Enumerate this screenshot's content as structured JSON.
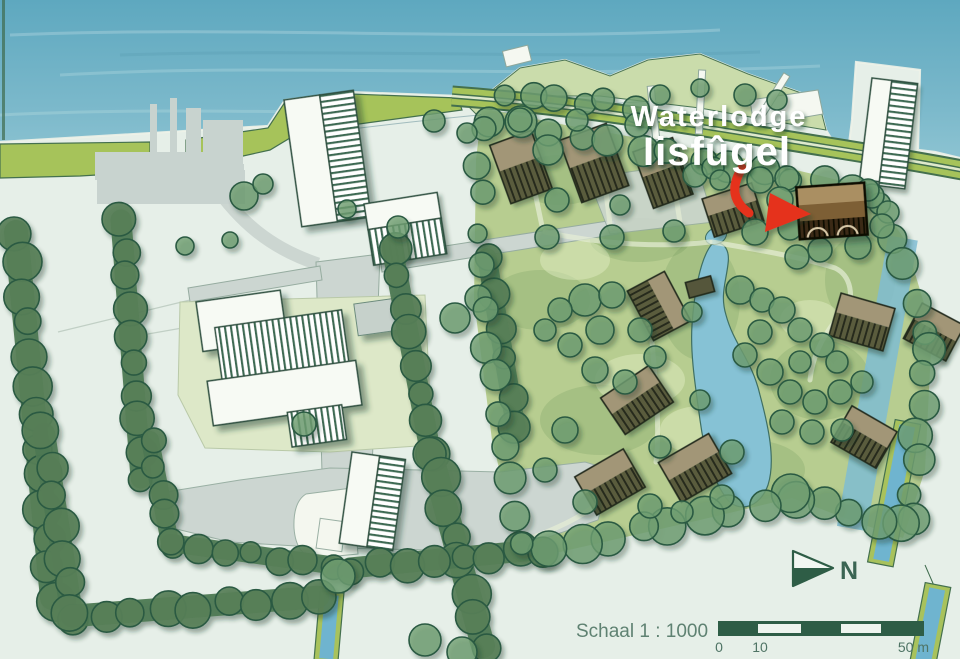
{
  "title": {
    "line1": "Waterlodge",
    "line2": "Iisfûgel"
  },
  "annotations": {
    "north_label": "N",
    "scale_label": "Schaal 1 : 1000",
    "scale_tick_0": "0",
    "scale_tick_10": "10",
    "scale_tick_50": "50 m"
  },
  "colors": {
    "water": "#69aec4",
    "water_shallow": "#93c7d3",
    "land": "#e6efe8",
    "headland": "#c9dba8",
    "park_grass": "#b7cd90",
    "dike": "#a6c35a",
    "dike_line": "#44704e",
    "road": "#ccd6d1",
    "road_edge": "#96aca0",
    "yard": "#dde8c8",
    "factory": "#c8d3cf",
    "building_white": "#f7faf4",
    "roof_hatch_line": "#3c6b52",
    "tree": "#6f9f72",
    "hedge": "#577e57",
    "outline": "#2b5a43",
    "pond": "#86c2d5",
    "canal": "#6fb4cf",
    "canal_bank": "#a8c25c",
    "lodge_light": "#a29677",
    "lodge_dark": "#55573b",
    "lodge_outline": "#20291c",
    "highlight_band_top": "#aa8f62",
    "highlight_band_mid": "#7d5f34",
    "highlight_band_dark": "#33270f",
    "highlight_outline": "#0d0c06",
    "arrow": "#e5301f",
    "title_text": "#ffffff",
    "map_text": "#5f8272",
    "north_text": "#3b6553",
    "scalebar": "#2e5d46"
  }
}
